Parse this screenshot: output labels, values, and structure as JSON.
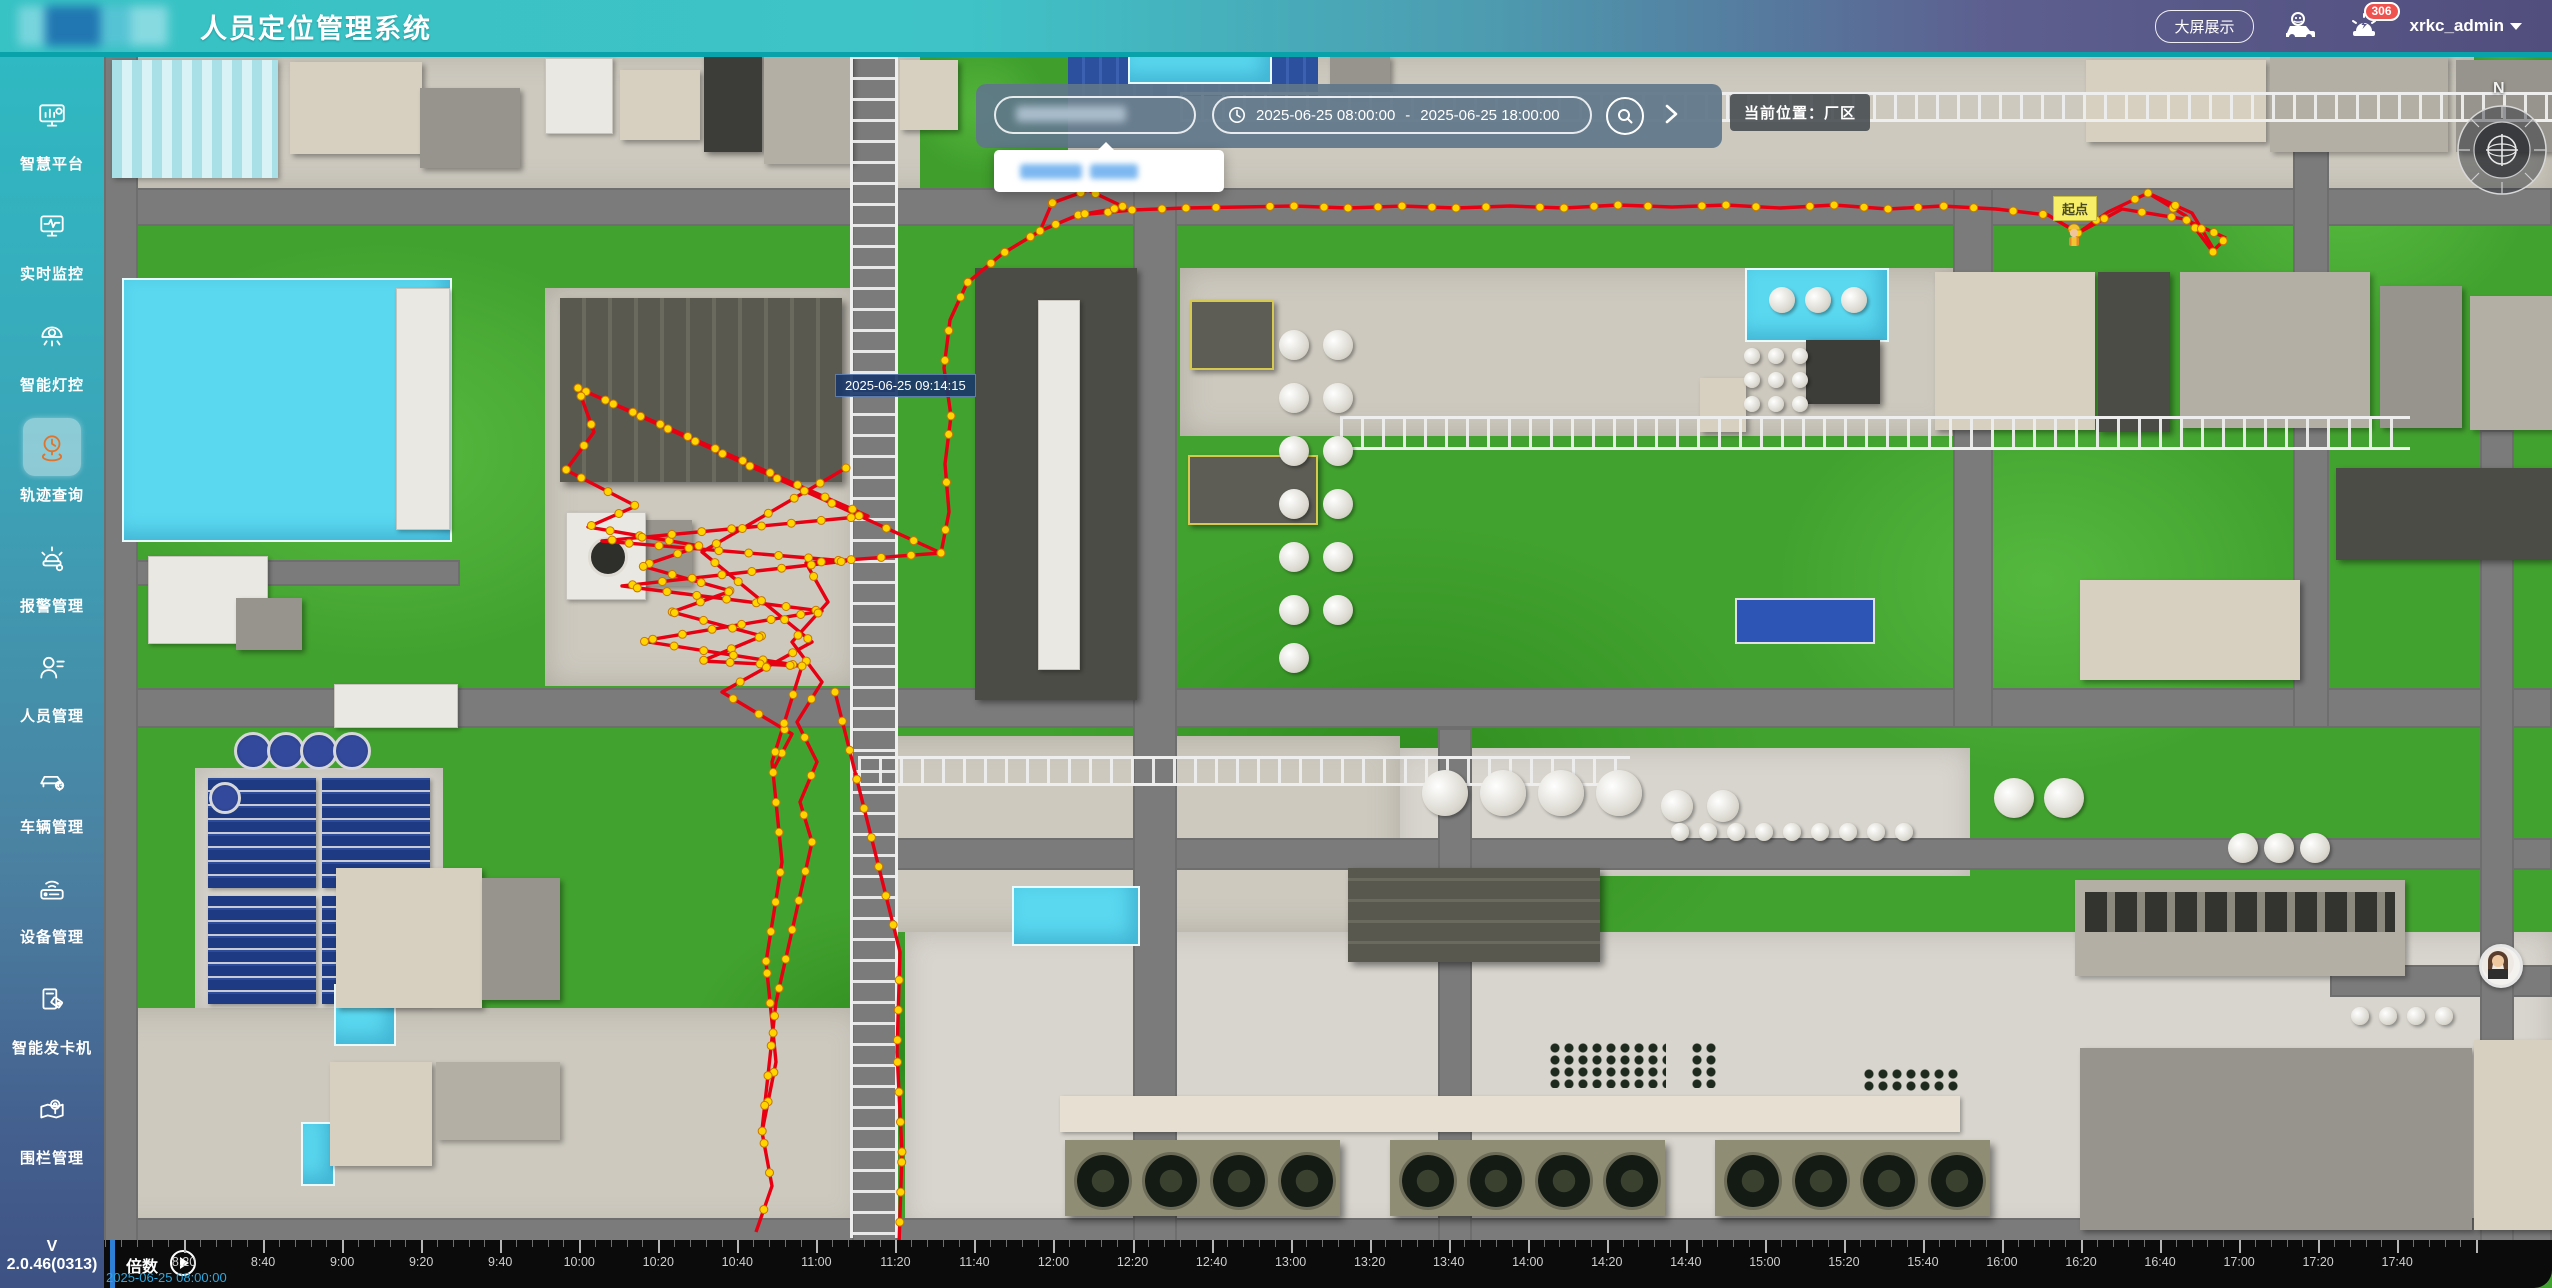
{
  "header": {
    "title": "人员定位管理系统",
    "big_screen_label": "大屏展示",
    "alarm_count": "306",
    "username": "xrkc_admin",
    "icons": [
      "vehicle-icon",
      "alarm-icon",
      "caret-down-icon"
    ]
  },
  "sidebar": {
    "items": [
      {
        "label": "智慧平台",
        "icon": "platform-icon",
        "active": false
      },
      {
        "label": "实时监控",
        "icon": "monitor-icon",
        "active": false
      },
      {
        "label": "智能灯控",
        "icon": "lamp-icon",
        "active": false
      },
      {
        "label": "轨迹查询",
        "icon": "track-icon",
        "active": true
      },
      {
        "label": "报警管理",
        "icon": "alarm-manage-icon",
        "active": false
      },
      {
        "label": "人员管理",
        "icon": "person-icon",
        "active": false
      },
      {
        "label": "车辆管理",
        "icon": "vehicle-manage-icon",
        "active": false
      },
      {
        "label": "设备管理",
        "icon": "device-icon",
        "active": false
      },
      {
        "label": "智能发卡机",
        "icon": "card-machine-icon",
        "active": false
      },
      {
        "label": "围栏管理",
        "icon": "fence-icon",
        "active": false
      }
    ],
    "version": "V 2.0.46(0313)"
  },
  "toolbar": {
    "search_value": "",
    "time_start": "2025-06-25 08:00:00",
    "time_separator": "-",
    "time_end": "2025-06-25 18:00:00",
    "location_label": "当前位置：厂区"
  },
  "map": {
    "tooltip_time": "2025-06-25 09:14:15",
    "start_point_label": "起点",
    "compass_label": "N",
    "colors": {
      "trajectory": "#e60012",
      "trajectory_dot": "#ffd400",
      "trajectory_dot_edge": "#c77700"
    },
    "trajectory": {
      "paths": [
        [
          [
            2213,
            252
          ],
          [
            2186,
            216
          ],
          [
            2148,
            193
          ],
          [
            2108,
            212
          ],
          [
            2078,
            233
          ],
          [
            2048,
            215
          ],
          [
            1996,
            209
          ],
          [
            1942,
            206
          ],
          [
            1888,
            209
          ],
          [
            1834,
            205
          ],
          [
            1780,
            208
          ],
          [
            1726,
            205
          ],
          [
            1672,
            207
          ],
          [
            1618,
            205
          ],
          [
            1564,
            208
          ],
          [
            1510,
            206
          ],
          [
            1456,
            208
          ],
          [
            1402,
            206
          ],
          [
            1348,
            208
          ],
          [
            1294,
            206
          ],
          [
            1240,
            207
          ],
          [
            1186,
            208
          ],
          [
            1132,
            210
          ],
          [
            1078,
            215
          ],
          [
            1040,
            231
          ],
          [
            1002,
            254
          ],
          [
            967,
            283
          ],
          [
            950,
            320
          ],
          [
            944,
            368
          ],
          [
            951,
            416
          ],
          [
            945,
            464
          ],
          [
            949,
            512
          ],
          [
            941,
            553
          ]
        ],
        [
          [
            2148,
            193
          ],
          [
            2192,
            213
          ],
          [
            2214,
            250
          ],
          [
            2226,
            238
          ]
        ],
        [
          [
            2078,
            233
          ],
          [
            2122,
            209
          ],
          [
            2184,
            219
          ],
          [
            2226,
            238
          ]
        ],
        [
          [
            1040,
            231
          ],
          [
            1052,
            203
          ],
          [
            1088,
            190
          ],
          [
            1124,
            207
          ],
          [
            1078,
            215
          ]
        ],
        [
          [
            941,
            553
          ],
          [
            578,
            388
          ],
          [
            594,
            432
          ],
          [
            566,
            470
          ],
          [
            636,
            506
          ],
          [
            588,
            527
          ],
          [
            700,
            546
          ],
          [
            642,
            566
          ],
          [
            731,
            591
          ],
          [
            672,
            612
          ],
          [
            762,
            636
          ],
          [
            702,
            661
          ]
        ],
        [
          [
            578,
            388
          ],
          [
            868,
            516
          ],
          [
            602,
            541
          ],
          [
            846,
            561
          ],
          [
            622,
            586
          ],
          [
            822,
            611
          ],
          [
            642,
            641
          ],
          [
            802,
            666
          ],
          [
            702,
            661
          ]
        ],
        [
          [
            846,
            468
          ],
          [
            702,
            552
          ],
          [
            812,
            642
          ],
          [
            722,
            692
          ],
          [
            792,
            734
          ],
          [
            772,
            772
          ]
        ],
        [
          [
            941,
            553
          ],
          [
            806,
            563
          ],
          [
            828,
            602
          ],
          [
            792,
            642
          ],
          [
            822,
            682
          ],
          [
            797,
            722
          ],
          [
            817,
            762
          ],
          [
            800,
            802
          ],
          [
            812,
            842
          ]
        ],
        [
          [
            802,
            666
          ],
          [
            772,
            762
          ],
          [
            782,
            862
          ],
          [
            766,
            962
          ],
          [
            776,
            1062
          ],
          [
            762,
            1132
          ],
          [
            772,
            1186
          ],
          [
            756,
            1232
          ]
        ],
        [
          [
            835,
            692
          ],
          [
            900,
            952
          ],
          [
            897,
            1052
          ],
          [
            902,
            1152
          ],
          [
            899,
            1246
          ]
        ],
        [
          [
            812,
            842
          ],
          [
            776,
            1002
          ],
          [
            762,
            1130
          ]
        ]
      ]
    }
  },
  "timeline": {
    "speed_label": "倍数",
    "current_time": "2025-06-25 08:00:00",
    "tick_labels": [
      "8:20",
      "8:40",
      "9:00",
      "9:20",
      "9:40",
      "10:00",
      "10:20",
      "10:40",
      "11:00",
      "11:20",
      "11:40",
      "12:00",
      "12:20",
      "12:40",
      "13:00",
      "13:20",
      "13:40",
      "14:00",
      "14:20",
      "14:40",
      "15:00",
      "15:20",
      "15:40",
      "16:00",
      "16:20",
      "16:40",
      "17:00",
      "17:20",
      "17:40"
    ]
  }
}
